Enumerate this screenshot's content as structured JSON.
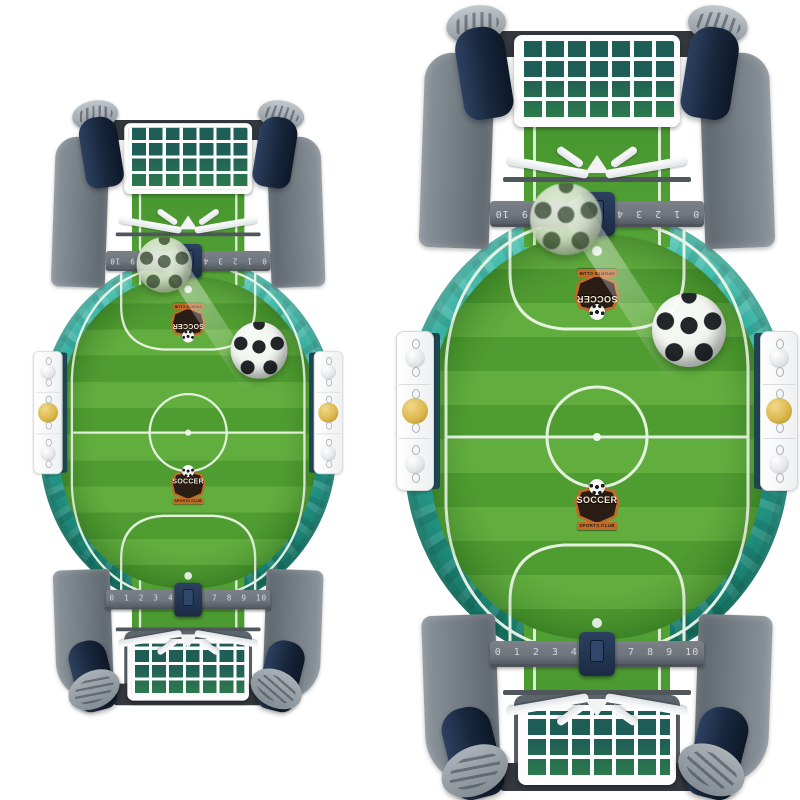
{
  "board": {
    "badge": {
      "title": "SOCCER",
      "subtitle": "SPORTS CLUB"
    },
    "score_ruler": {
      "numbers": "0 1 2 3 4 5 6 7 8 9 10"
    }
  },
  "icons": {
    "soccer_ball": "white circle with black pentagon spots (css radial gradients)"
  },
  "colors": {
    "bg": "#ffffff",
    "rim-teal": "#2aa99b",
    "rim-teal-light": "#46c2b0",
    "rim-teal-dark": "#18806f",
    "grass-light": "#61ad3e",
    "grass-dark": "#4f9c31",
    "channel-green": "#3f8f2b",
    "line-white": "#edf6e8",
    "frame-gray": "#8b939b",
    "frame-gray-dark": "#5d656d",
    "crossbar-gray": "#33383e",
    "knob-navy": "#18263c",
    "ruler-gray": "#70767d",
    "ruler-text": "#d6dadd",
    "slider-navy": "#1c2b45",
    "gold": "#dcb84d",
    "silver": "#e4e7e9",
    "badge-dark": "#2a1d16",
    "badge-orange": "#c06b28",
    "badge-cream": "#f4e9d2"
  }
}
